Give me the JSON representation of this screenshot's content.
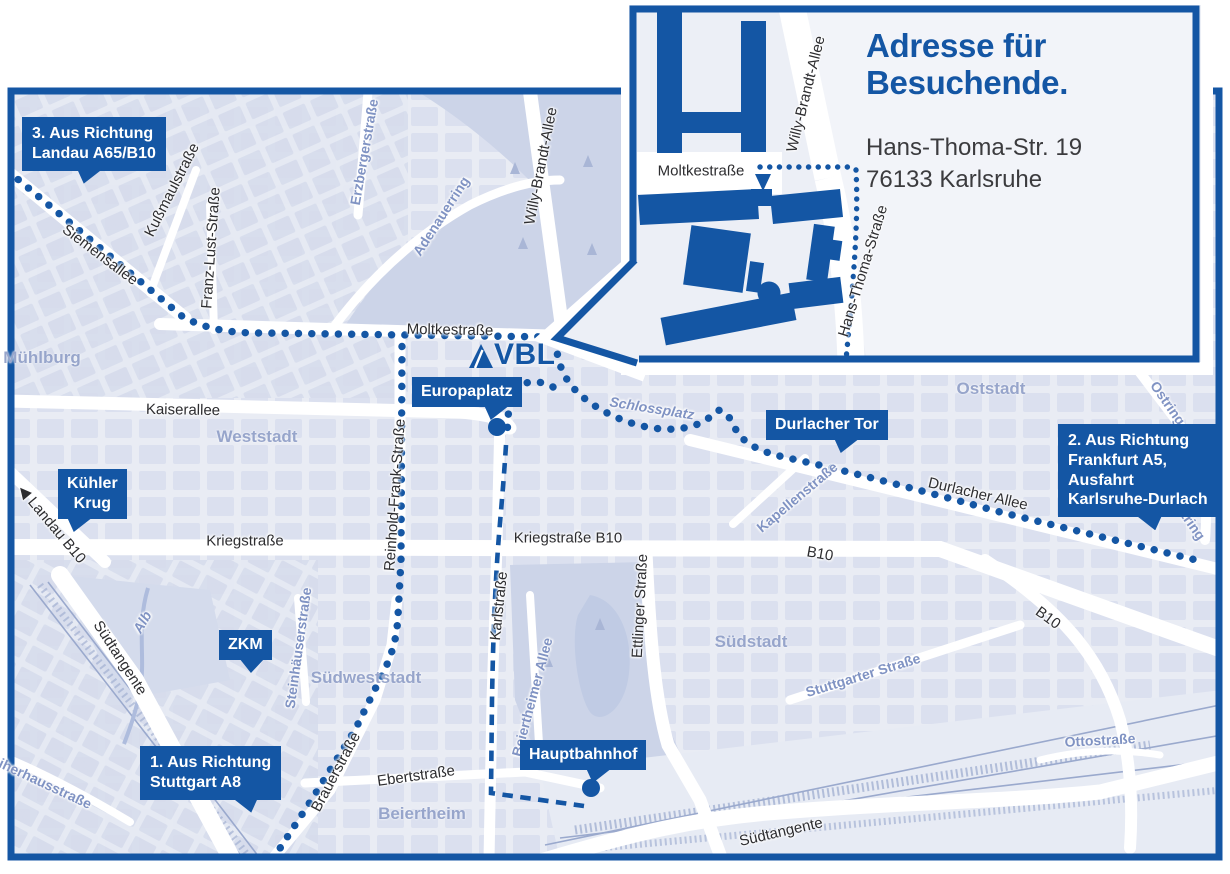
{
  "colors": {
    "primary_blue": "#1456a4",
    "map_bg": "#e9ecf4",
    "block": "#d8deee",
    "park": "#ccd4e8",
    "lake": "#c0cbe4",
    "road": "#ffffff",
    "dark_text": "#2d2d30",
    "blue_street": "#8093c3",
    "district": "#97a5cb",
    "inset_bg": "#eceff6",
    "inset_panel": "#f2f4f9",
    "rail": "#9aa9cd"
  },
  "inset": {
    "title_line1": "Adresse für",
    "title_line2": "Besuchende.",
    "address_line1": "Hans-Thoma-Str. 19",
    "address_line2": "76133 Karlsruhe",
    "streets": [
      {
        "text": "Moltkestraße",
        "x": 701,
        "y": 171,
        "rot": 0,
        "kind": "dark"
      },
      {
        "text": "Willy-Brandt-Allee",
        "x": 806,
        "y": 94,
        "rot": -76,
        "kind": "dark"
      },
      {
        "text": "Hans-Thoma-Straße",
        "x": 863,
        "y": 271,
        "rot": -73,
        "kind": "dark"
      }
    ]
  },
  "map": {
    "logo_text": "VBL",
    "direction_labels": [
      {
        "id": "dir-3",
        "lines": [
          "3. Aus Richtung",
          "Landau A65/B10"
        ],
        "x": 22,
        "y": 117,
        "tail_x": 55,
        "tail_dir": "dl"
      },
      {
        "id": "dir-1",
        "lines": [
          "1. Aus Richtung",
          "Stuttgart A8"
        ],
        "x": 140,
        "y": 746,
        "tail_x": 92,
        "tail_dir": "dr"
      },
      {
        "id": "dir-2",
        "lines": [
          "2. Aus Richtung",
          "Frankfurt A5,",
          "Ausfahrt",
          "Karlsruhe-Durlach"
        ],
        "x": 1058,
        "y": 424,
        "tail_x": 78,
        "tail_dir": "dr"
      }
    ],
    "badges": [
      {
        "id": "kuehler-krug",
        "lines": [
          "Kühler",
          "Krug"
        ],
        "x": 58,
        "y": 469,
        "tail_x": 9,
        "tail_dir": "dl",
        "center": true
      },
      {
        "id": "zkm",
        "lines": [
          "ZKM"
        ],
        "x": 219,
        "y": 630,
        "tail_x": 20,
        "tail_dir": "dc",
        "center": true
      },
      {
        "id": "europaplatz",
        "lines": [
          "Europaplatz"
        ],
        "x": 412,
        "y": 377,
        "tail_x": 72,
        "tail_dir": "dl",
        "center": false
      },
      {
        "id": "durlacher-tor",
        "lines": [
          "Durlacher Tor"
        ],
        "x": 766,
        "y": 410,
        "tail_x": 68,
        "tail_dir": "dl",
        "center": false
      },
      {
        "id": "hauptbahnhof",
        "lines": [
          "Hauptbahnhof"
        ],
        "x": 520,
        "y": 740,
        "tail_x": 66,
        "tail_dir": "dl",
        "center": false
      }
    ],
    "districts": [
      {
        "text": "Mühlburg",
        "x": 42,
        "y": 358
      },
      {
        "text": "Weststadt",
        "x": 257,
        "y": 437
      },
      {
        "text": "Oststadt",
        "x": 991,
        "y": 389
      },
      {
        "text": "Südstadt",
        "x": 751,
        "y": 642
      },
      {
        "text": "Südweststadt",
        "x": 366,
        "y": 678
      },
      {
        "text": "Beiertheim",
        "x": 422,
        "y": 814
      }
    ],
    "streets": [
      {
        "text": "Siemensallee",
        "x": 100,
        "y": 255,
        "rot": 37,
        "kind": "dark"
      },
      {
        "text": "Kußmaulstraße",
        "x": 172,
        "y": 190,
        "rot": -63,
        "kind": "dark"
      },
      {
        "text": "Franz-Lust-Straße",
        "x": 211,
        "y": 248,
        "rot": -86,
        "kind": "dark"
      },
      {
        "text": "Erzbergerstraße",
        "x": 364,
        "y": 152,
        "rot": -80,
        "kind": "blue"
      },
      {
        "text": "Adenauerring",
        "x": 441,
        "y": 216,
        "rot": -57,
        "kind": "blue"
      },
      {
        "text": "Willy-Brandt-Allee",
        "x": 541,
        "y": 166,
        "rot": -79,
        "kind": "dark"
      },
      {
        "text": "Moltkestraße",
        "x": 450,
        "y": 330,
        "rot": 1,
        "kind": "dark"
      },
      {
        "text": "Kaiserallee",
        "x": 183,
        "y": 410,
        "rot": 1,
        "kind": "dark"
      },
      {
        "text": "Reinhold-Frank-Straße",
        "x": 395,
        "y": 495,
        "rot": -86,
        "kind": "dark"
      },
      {
        "text": "Kriegstraße",
        "x": 245,
        "y": 541,
        "rot": 0,
        "kind": "dark"
      },
      {
        "text": "Kriegstraße B10",
        "x": 568,
        "y": 538,
        "rot": 0,
        "kind": "dark"
      },
      {
        "text": "Karlstraße",
        "x": 499,
        "y": 606,
        "rot": -84,
        "kind": "dark"
      },
      {
        "text": "Ettlinger Straße",
        "x": 640,
        "y": 606,
        "rot": -87,
        "kind": "dark"
      },
      {
        "text": "Beiertheimer Allee",
        "x": 532,
        "y": 697,
        "rot": -75,
        "kind": "blue"
      },
      {
        "text": "Schlossplatz",
        "x": 652,
        "y": 408,
        "rot": 9,
        "kind": "water"
      },
      {
        "text": "Durlacher Allee",
        "x": 978,
        "y": 494,
        "rot": 13,
        "kind": "dark"
      },
      {
        "text": "Kapellenstraße",
        "x": 797,
        "y": 497,
        "rot": -40,
        "kind": "blue"
      },
      {
        "text": "B10",
        "x": 820,
        "y": 554,
        "rot": 10,
        "kind": "dark"
      },
      {
        "text": "B10",
        "x": 1048,
        "y": 618,
        "rot": 36,
        "kind": "dark"
      },
      {
        "text": "Ostring",
        "x": 1168,
        "y": 403,
        "rot": 55,
        "kind": "blue"
      },
      {
        "text": "Ostring",
        "x": 1188,
        "y": 518,
        "rot": 55,
        "kind": "blue"
      },
      {
        "text": "Stuttgarter Straße",
        "x": 863,
        "y": 675,
        "rot": -17,
        "kind": "blue"
      },
      {
        "text": "Ottostraße",
        "x": 1100,
        "y": 740,
        "rot": -3,
        "kind": "blue"
      },
      {
        "text": "Südtangente",
        "x": 120,
        "y": 658,
        "rot": 57,
        "kind": "dark"
      },
      {
        "text": "Südtangente",
        "x": 781,
        "y": 832,
        "rot": -13,
        "kind": "dark"
      },
      {
        "text": "Brauerstraße",
        "x": 336,
        "y": 772,
        "rot": -62,
        "kind": "dark"
      },
      {
        "text": "Ebertstraße",
        "x": 416,
        "y": 776,
        "rot": -8,
        "kind": "dark"
      },
      {
        "text": "Steinhäuserstraße",
        "x": 298,
        "y": 648,
        "rot": -82,
        "kind": "blue"
      },
      {
        "text": "Alb",
        "x": 142,
        "y": 622,
        "rot": -60,
        "kind": "water"
      },
      {
        "text": "Weiherhausstraße",
        "x": 36,
        "y": 779,
        "rot": 25,
        "kind": "blue"
      },
      {
        "text": "◀ Landau B10",
        "x": 52,
        "y": 524,
        "rot": 50,
        "kind": "dark"
      }
    ]
  }
}
